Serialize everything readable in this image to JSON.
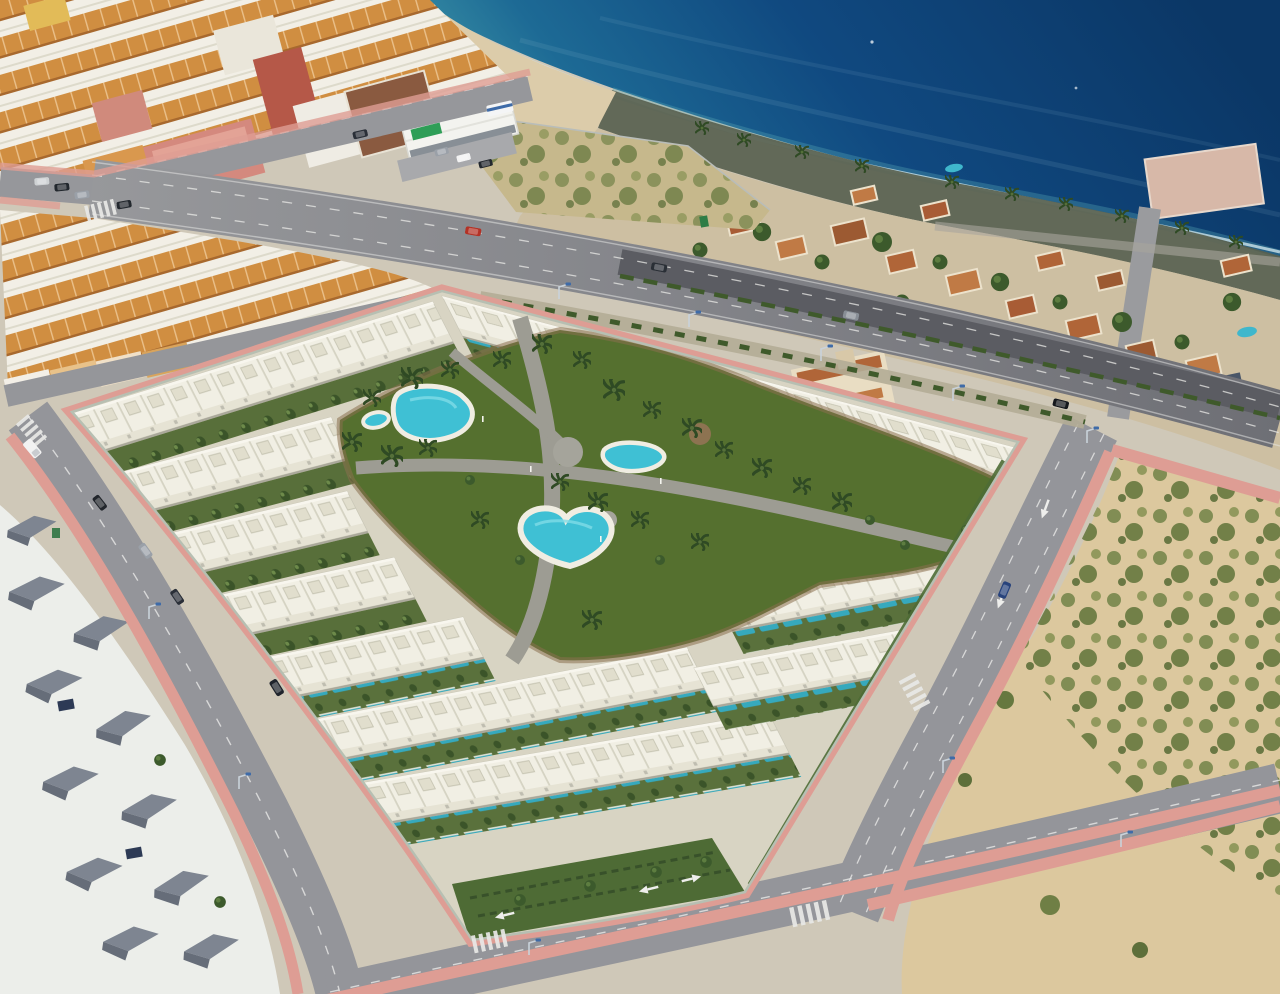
{
  "meta": {
    "image_type": "aerial-drone-photo-with-3d-render-composite",
    "description": "Aerial view of a coastal town: a photorealistic render of a new white townhouse development with communal gardens and pools is composited between an old town with terracotta roofs, a seafront villa district, a wide avenue and an empty sandy plot",
    "width_px": 1280,
    "height_px": 994
  },
  "scene": {
    "sea": {
      "position": "top-right",
      "colors": {
        "deep": "#0b3766",
        "mid": "#11518b",
        "shallow": "#3b93a6",
        "surf": "#d8ecef"
      }
    },
    "shore": {
      "beach_sand": "#dcccaa",
      "rocky_shore": "#59614f"
    },
    "old_town": {
      "position": "top-left",
      "roof_tile": "#d08e41",
      "walls": "#f2efe6",
      "apartment_blocks": [
        "#d4897e",
        "#b55848",
        "#8a5a40",
        "#d9984e",
        "#e2bb58"
      ],
      "supermarket": {
        "walls": "#f3f3ef",
        "sign_green": "#2e9e57"
      }
    },
    "villa_district": {
      "position": "right-of-avenue",
      "roof_terracotta": "#b06538",
      "trees": "#3d5429",
      "pool": "#3fb7cc"
    },
    "scrub_lot": {
      "position": "top-centre",
      "sand": "#c6b88c",
      "scrub": "#6f7f45",
      "fenced": true
    },
    "avenue": {
      "asphalt": "#9a9b9e",
      "resurfaced_dark": "#5b5c62",
      "median_hedge": "#3f5a2b",
      "lane_markings": "#e9e9e7",
      "lamp_head_blue": "#3e6ba8"
    },
    "development": {
      "position": "centre",
      "townhouse_rows": 11,
      "walls": "#f1efe4",
      "roof_boxes": "#e1decd",
      "private_gardens": "#586f3a",
      "private_lap_pools": "#36a9bd",
      "perimeter_wall": "#b7bfb2",
      "perimeter_sidewalk_pink": "#de9d94"
    },
    "communal_courtyard": {
      "lawn": "#55702f",
      "paths_grey": "#9d9c93",
      "dirt_margin": "#8a6f4e",
      "palms": "#2f4a24",
      "pools": {
        "count": 4,
        "water": "#3fc0d4",
        "deck": "#f0ede2",
        "shapes": [
          "large-kidney",
          "small-pond",
          "medium-kidney",
          "heart"
        ]
      }
    },
    "dirt_lot": {
      "position": "bottom-right",
      "sand": "#dcc89e",
      "scrub": "#66783f"
    },
    "existing_houses": {
      "position": "bottom-left",
      "walls": "#eceeea",
      "roofs_grey": "#7e8591",
      "solar_panels": "#2d3a55"
    },
    "streets": {
      "asphalt": "#94959a",
      "sidewalk_pink": "#de9d94",
      "crosswalks": 5,
      "parked_vehicles": [
        "white-van",
        "dark-cars",
        "grey-car",
        "dark-blue-car",
        "red-car",
        "bus"
      ]
    }
  }
}
